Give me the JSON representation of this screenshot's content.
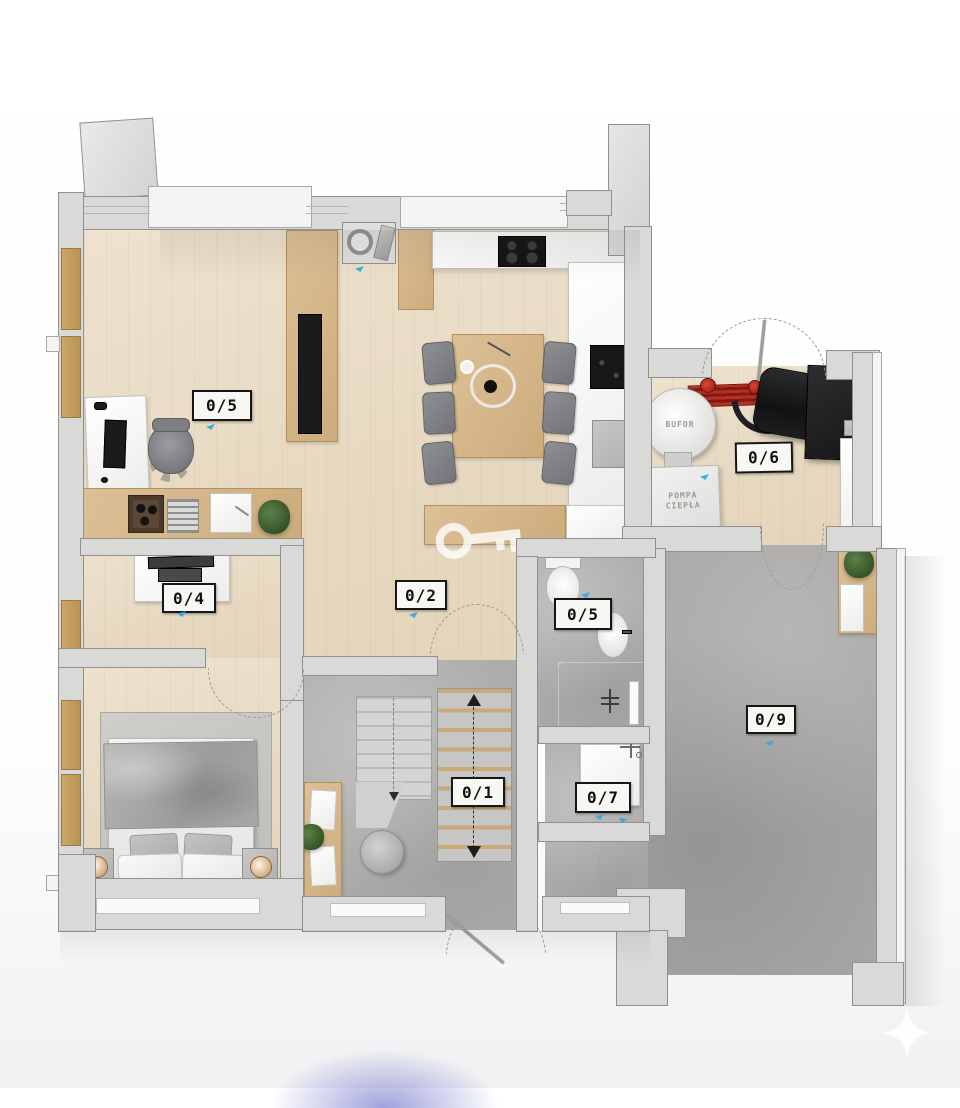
{
  "scene": {
    "kind": "3d-floor-plan-top-view",
    "level": "ground-floor"
  },
  "room_labels": [
    {
      "room": "office",
      "label": "0/5"
    },
    {
      "room": "living-dining-kitchen",
      "label": "0/2"
    },
    {
      "room": "wardrobe-room",
      "label": "0/4"
    },
    {
      "room": "utility-room",
      "label": "0/6"
    },
    {
      "room": "bathroom",
      "label": "0/5"
    },
    {
      "room": "hall-stairs",
      "label": "0/1"
    },
    {
      "room": "laundry-room",
      "label": "0/7"
    },
    {
      "room": "garage",
      "label": "0/9"
    }
  ],
  "equipment_labels": {
    "buffer_tank": "BUFOR",
    "heat_pump_line1": "POMPA",
    "heat_pump_line2": "CIEPŁA"
  },
  "palette": {
    "background": "#fbfbfc",
    "wood_floor": "#e7dac3",
    "wood_furniture": "#d2b68c",
    "concrete_floor": "#abaaa8",
    "wall_fill": "#d9d9d7",
    "wall_edge": "#8f8f8d",
    "wall_cap": "#f3f3f1",
    "label_border": "#161616",
    "label_bg": "#f7f7f4",
    "accent_marker": "#2fa7dd",
    "pipe_red": "#c22a22",
    "appliance_black": "#1b1b1d",
    "plant_green": "#3f6b35",
    "blob_purple": "#8287d2"
  }
}
